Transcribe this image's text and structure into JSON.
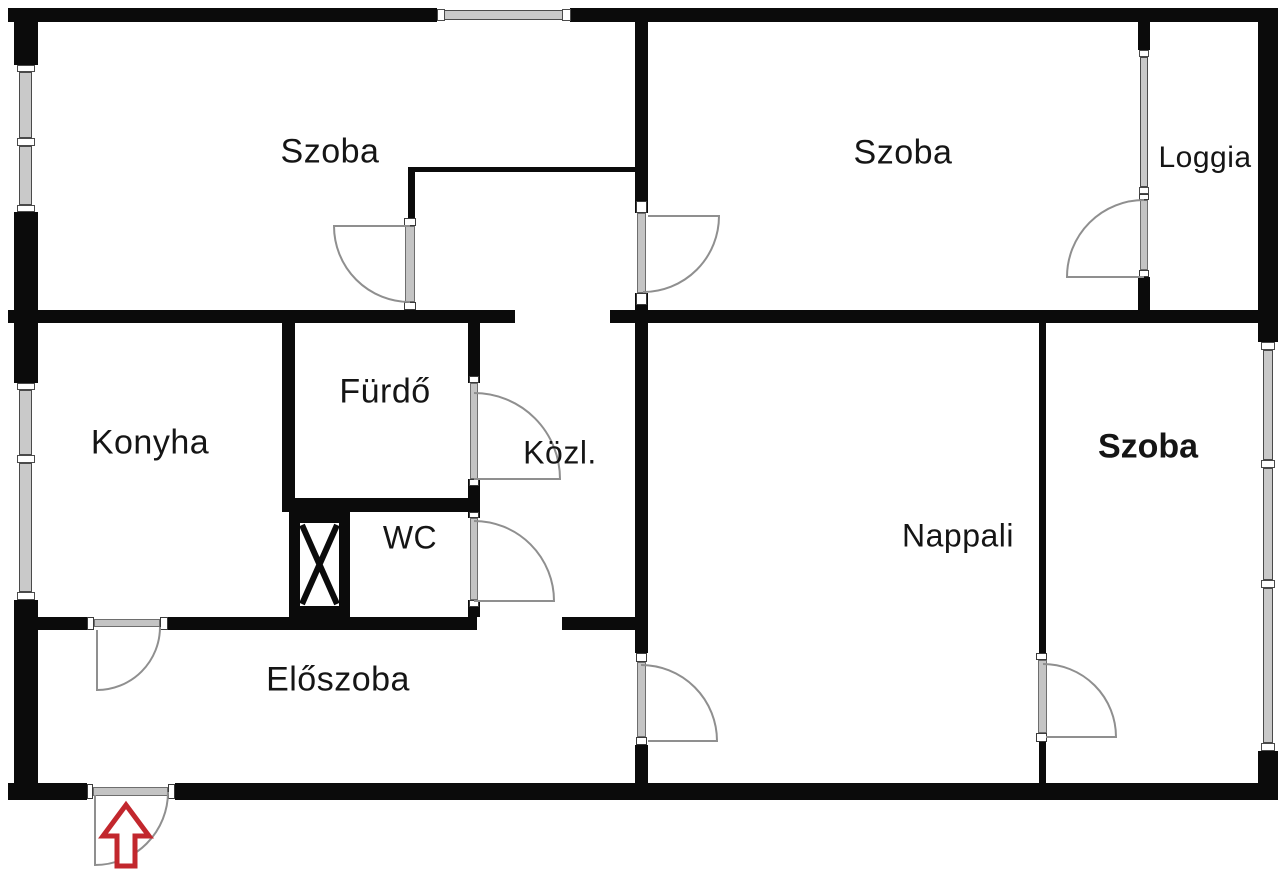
{
  "scene": {
    "w": 1280,
    "h": 875,
    "bg": "#ffffff"
  },
  "style": {
    "wall_color": "#0b0b0b",
    "window_fill": "#c9c9c9",
    "window_edge": "#4a4a4a",
    "door_fill": "#c4c4c4",
    "door_edge": "#6e6e6e",
    "jamb_fill": "#ffffff",
    "jamb_edge": "#3a3a3a",
    "door_arc_color": "#8f8f8f",
    "label_color": "#151515",
    "arrow_color": "#c2272d",
    "shaft_inner": "#ffffff"
  },
  "rooms": [
    {
      "id": "szoba-top-left",
      "label": "Szoba",
      "cx": 330,
      "cy": 152,
      "fs": 34,
      "bold": false
    },
    {
      "id": "szoba-top-right",
      "label": "Szoba",
      "cx": 903,
      "cy": 153,
      "fs": 34,
      "bold": false
    },
    {
      "id": "loggia",
      "label": "Loggia",
      "cx": 1205,
      "cy": 158,
      "fs": 30,
      "bold": false
    },
    {
      "id": "konyha",
      "label": "Konyha",
      "cx": 150,
      "cy": 443,
      "fs": 34,
      "bold": false
    },
    {
      "id": "furdo",
      "label": "Fürdő",
      "cx": 385,
      "cy": 392,
      "fs": 34,
      "bold": false
    },
    {
      "id": "kozl",
      "label": "Közl.",
      "cx": 560,
      "cy": 453,
      "fs": 32,
      "bold": false
    },
    {
      "id": "wc",
      "label": "WC",
      "cx": 410,
      "cy": 538,
      "fs": 32,
      "bold": false
    },
    {
      "id": "nappali",
      "label": "Nappali",
      "cx": 958,
      "cy": 536,
      "fs": 32,
      "bold": false
    },
    {
      "id": "szoba-bottom-right",
      "label": "Szoba",
      "cx": 1148,
      "cy": 447,
      "fs": 34,
      "bold": true
    },
    {
      "id": "eloszoba",
      "label": "Előszoba",
      "cx": 338,
      "cy": 680,
      "fs": 34,
      "bold": false
    }
  ],
  "walls": [
    [
      8,
      8,
      429,
      14
    ],
    [
      570,
      8,
      708,
      14
    ],
    [
      14,
      8,
      24,
      57
    ],
    [
      14,
      212,
      24,
      171
    ],
    [
      14,
      600,
      24,
      200
    ],
    [
      8,
      783,
      79,
      17
    ],
    [
      175,
      783,
      1103,
      17
    ],
    [
      1258,
      8,
      20,
      334
    ],
    [
      1258,
      751,
      20,
      49
    ],
    [
      8,
      310,
      507,
      13
    ],
    [
      610,
      310,
      668,
      13
    ],
    [
      635,
      21,
      13,
      192
    ],
    [
      635,
      293,
      13,
      30
    ],
    [
      635,
      323,
      13,
      330
    ],
    [
      635,
      745,
      13,
      38
    ],
    [
      282,
      323,
      13,
      175
    ],
    [
      282,
      498,
      198,
      14
    ],
    [
      468,
      323,
      12,
      60
    ],
    [
      468,
      479,
      12,
      33
    ],
    [
      468,
      512,
      12,
      6
    ],
    [
      468,
      600,
      12,
      17
    ],
    [
      38,
      617,
      56,
      13
    ],
    [
      160,
      617,
      317,
      13
    ],
    [
      562,
      617,
      86,
      13
    ],
    [
      1039,
      323,
      7,
      330
    ],
    [
      1039,
      742,
      7,
      41
    ],
    [
      410,
      167,
      228,
      5
    ],
    [
      408,
      167,
      7,
      51
    ],
    [
      1138,
      8,
      12,
      42
    ],
    [
      1138,
      277,
      12,
      41
    ]
  ],
  "window_bases": [
    [
      437,
      8,
      133,
      14
    ],
    [
      14,
      65,
      24,
      147
    ],
    [
      14,
      383,
      24,
      217
    ],
    [
      1138,
      50,
      12,
      150
    ],
    [
      1258,
      342,
      20,
      409
    ]
  ],
  "window_strips": [
    [
      444,
      10,
      119,
      10
    ],
    [
      19,
      72,
      13,
      66
    ],
    [
      19,
      146,
      13,
      59
    ],
    [
      19,
      390,
      13,
      65
    ],
    [
      19,
      463,
      13,
      129
    ],
    [
      1140,
      57,
      8,
      130
    ],
    [
      1263,
      350,
      10,
      110
    ],
    [
      1263,
      468,
      10,
      112
    ],
    [
      1263,
      588,
      10,
      155
    ]
  ],
  "window_caps": [
    [
      437,
      9,
      8,
      12
    ],
    [
      562,
      9,
      9,
      12
    ],
    [
      17,
      65,
      18,
      7
    ],
    [
      17,
      138,
      18,
      8
    ],
    [
      17,
      205,
      18,
      7
    ],
    [
      17,
      383,
      18,
      7
    ],
    [
      17,
      455,
      18,
      8
    ],
    [
      17,
      592,
      18,
      8
    ],
    [
      1139,
      50,
      10,
      7
    ],
    [
      1139,
      187,
      10,
      7
    ],
    [
      1261,
      342,
      14,
      8
    ],
    [
      1261,
      460,
      14,
      8
    ],
    [
      1261,
      580,
      14,
      8
    ],
    [
      1261,
      743,
      14,
      8
    ]
  ],
  "door_jambs": [
    [
      404,
      218,
      12,
      8
    ],
    [
      404,
      302,
      12,
      8
    ],
    [
      636,
      201,
      11,
      12
    ],
    [
      636,
      293,
      11,
      12
    ],
    [
      1139,
      194,
      10,
      6
    ],
    [
      1139,
      270,
      10,
      7
    ],
    [
      469,
      376,
      10,
      7
    ],
    [
      469,
      479,
      10,
      7
    ],
    [
      469,
      512,
      10,
      6
    ],
    [
      469,
      600,
      10,
      7
    ],
    [
      87,
      617,
      7,
      13
    ],
    [
      160,
      617,
      8,
      13
    ],
    [
      87,
      784,
      6,
      15
    ],
    [
      168,
      784,
      7,
      15
    ],
    [
      636,
      653,
      11,
      9
    ],
    [
      636,
      737,
      11,
      8
    ],
    [
      1036,
      653,
      11,
      7
    ],
    [
      1036,
      733,
      11,
      9
    ]
  ],
  "door_strips": [
    [
      405,
      226,
      10,
      76
    ],
    [
      637,
      213,
      9,
      80
    ],
    [
      1140,
      200,
      8,
      70
    ],
    [
      470,
      383,
      8,
      96
    ],
    [
      470,
      518,
      8,
      82
    ],
    [
      94,
      619,
      66,
      8
    ],
    [
      93,
      787,
      75,
      9
    ],
    [
      637,
      662,
      9,
      75
    ],
    [
      1038,
      660,
      9,
      73
    ]
  ],
  "door_arcs": [
    "M 410 226 L 334 226 A 76 76 0 0 0 410 302",
    "M 648 216 L 719 216 A 76 76 0 0 1 643 292",
    "M 1144 200 A 77 77 0 0 0 1067 277 L 1144 277",
    "M 474 393 A 86 86 0 0 1 560 479 L 474 479",
    "M 474 521 A 80 80 0 0 1 554 601 L 474 601",
    "M 97 630 L 97 690 A 63 63 0 0 0 160 627",
    "M 95 795 L 95 865 A 73 73 0 0 0 168 792",
    "M 641 665 A 76 76 0 0 1 717 741 L 648 741",
    "M 1043 664 A 73 73 0 0 1 1116 737 L 1046 737"
  ],
  "shaft": {
    "frame": [
      289,
      512,
      61,
      105
    ],
    "inner": [
      300,
      523,
      39,
      83
    ],
    "x_path": "M 302 525 L 337 604 M 337 525 L 302 604"
  },
  "entrance_arrow": {
    "path": "M 126 805 L 103 836 L 117 836 L 117 866 L 135 866 L 135 836 L 149 836 Z",
    "stroke_width": 5
  }
}
